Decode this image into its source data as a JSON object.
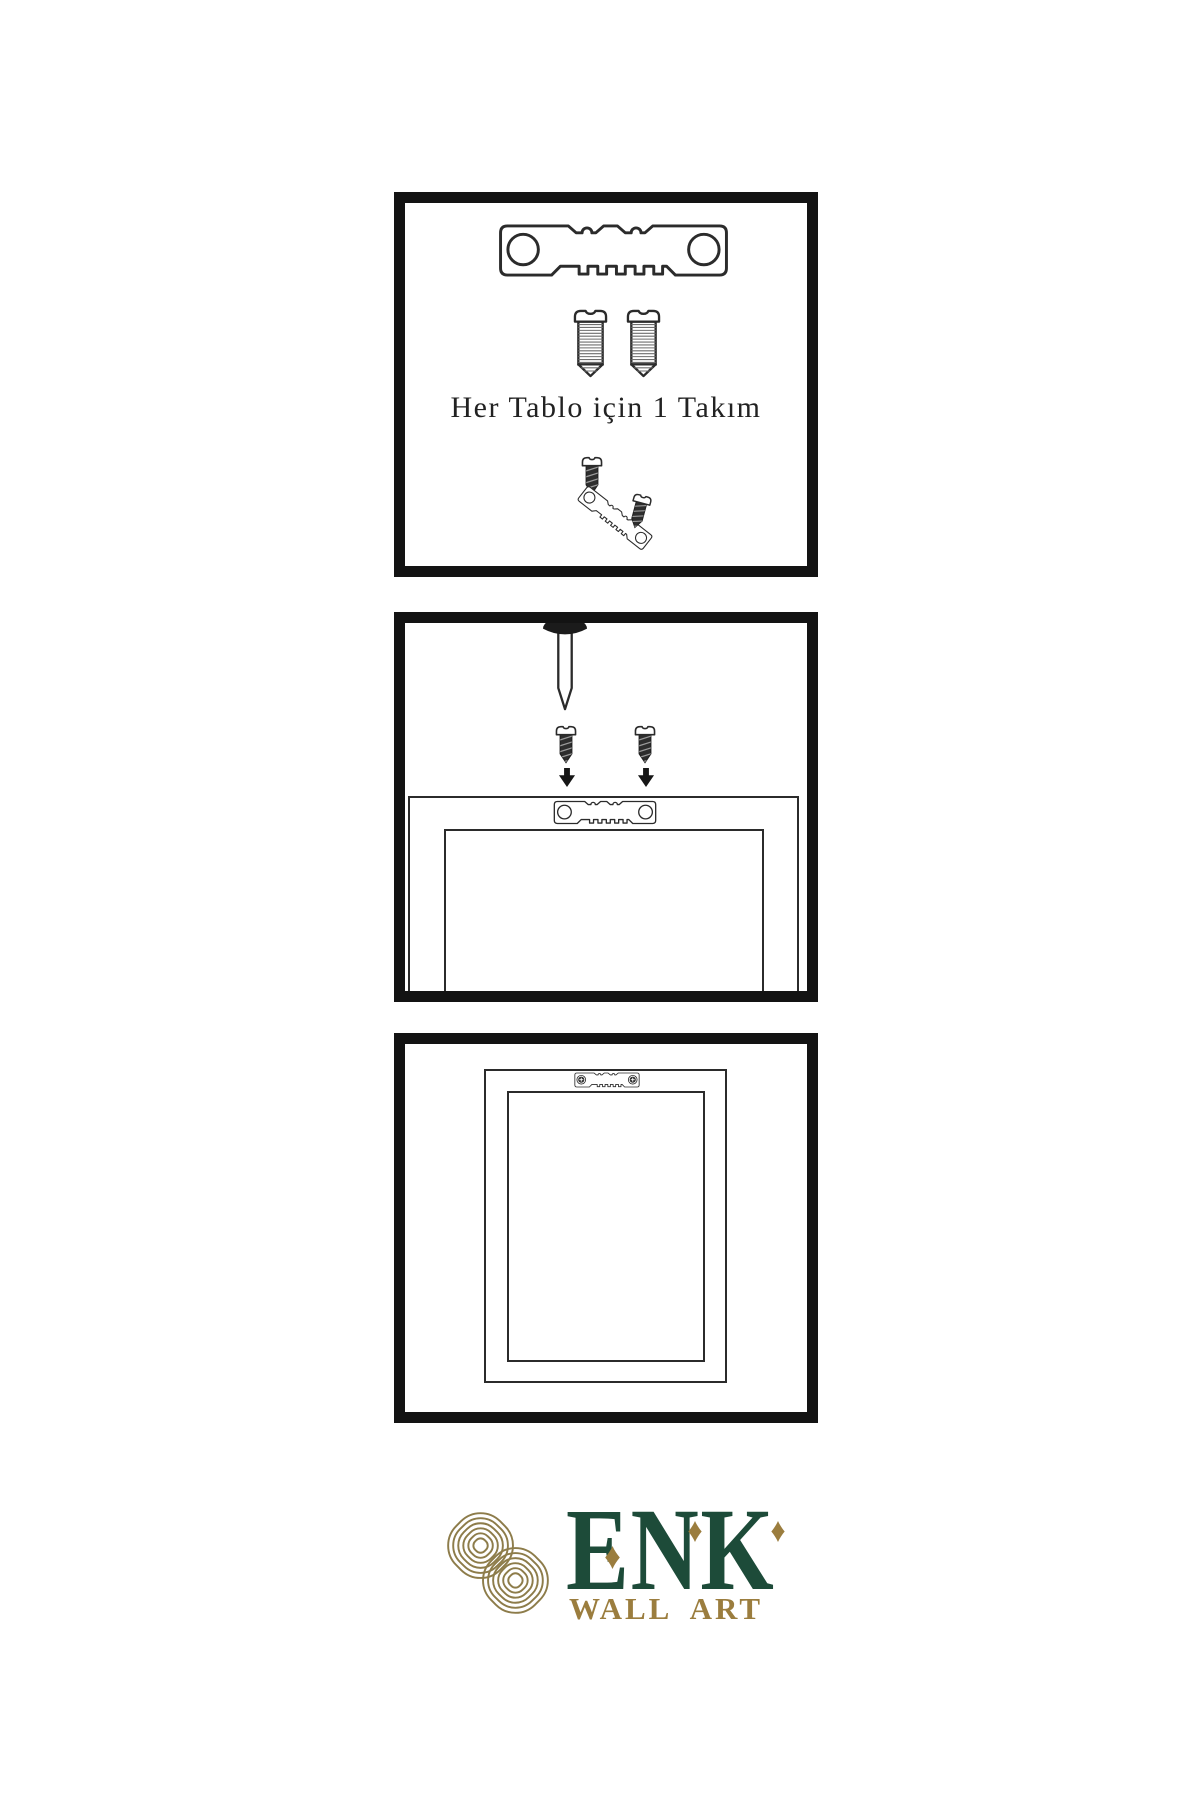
{
  "page": {
    "background": "#ffffff"
  },
  "colors": {
    "outline": "#2b2b2b",
    "panel_border": "#131313",
    "screw_dark_fill": "#2d2d2d",
    "arrow": "#161616",
    "nail_head": "#1b1b1b",
    "logo_green": "#1d4b39",
    "logo_gold": "#9b7d3e",
    "knot_gold": "#8d7c4a"
  },
  "panels": {
    "kit": {
      "caption": "Her Tablo için 1 Takım",
      "items": [
        "sawtooth-hanger",
        "screw",
        "screw",
        "screw-short",
        "tilted-sawtooth-hanger",
        "screw-short"
      ]
    },
    "install": {
      "items": [
        "wall-nail",
        "screw-short",
        "screw-short",
        "arrow-down",
        "arrow-down",
        "frame-back",
        "sawtooth-hanger-mounted"
      ]
    },
    "hang": {
      "items": [
        "frame-back",
        "sawtooth-hanger-screwed"
      ]
    }
  },
  "logo": {
    "brand": "ENK",
    "subtitle": "WALL ART"
  },
  "icons": {
    "sawtooth_hanger": "metal-bar-two-holes-sawtooth-teeth",
    "screw_long": "slotted-threaded-screw",
    "screw_short": "slotted-dark-screw",
    "nail": "wall-nail",
    "arrow_down": "▼",
    "crosshead": "＋",
    "knot": "interlaced-knot-monogram",
    "diamond": "◆"
  }
}
